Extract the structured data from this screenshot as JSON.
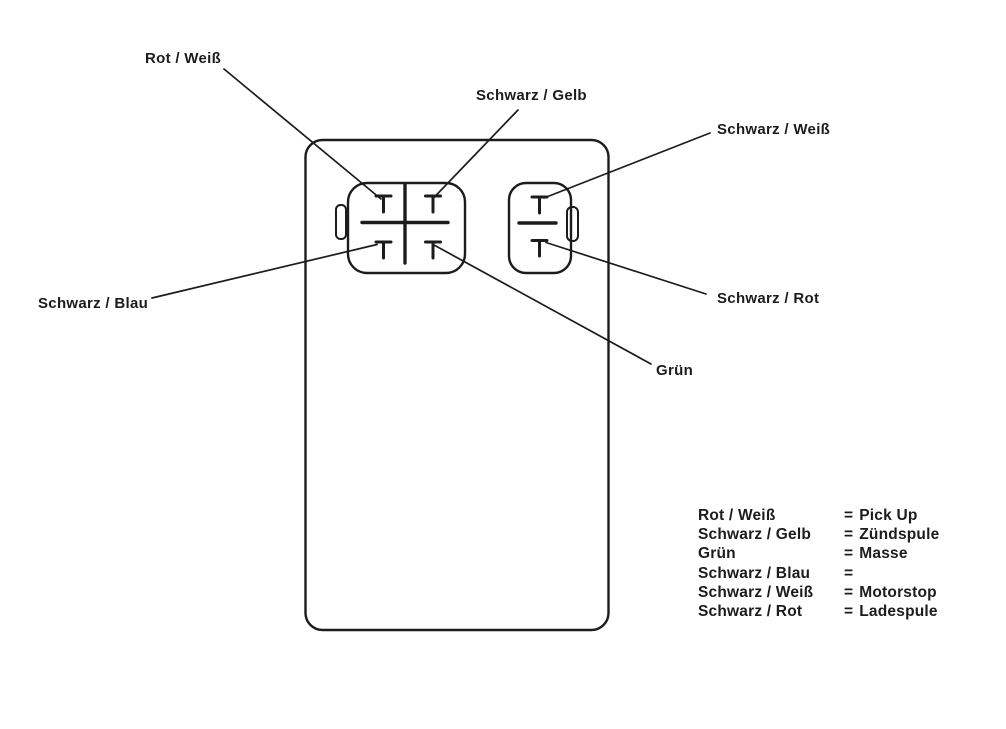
{
  "page": {
    "background_color": "#ffffff",
    "ink_color": "#1c1c1c",
    "kind": "CDI unit wiring diagram"
  },
  "labels": {
    "rot_weiss": "Rot / Weiß",
    "schwarz_gelb": "Schwarz / Gelb",
    "schwarz_weiss": "Schwarz / Weiß",
    "schwarz_rot": "Schwarz / Rot",
    "schwarz_blau": "Schwarz / Blau",
    "gruen": "Grün"
  },
  "connections": [
    {
      "wire": "Rot / Weiß",
      "pin": "4pin-top-left"
    },
    {
      "wire": "Schwarz / Gelb",
      "pin": "4pin-top-right"
    },
    {
      "wire": "Schwarz / Blau",
      "pin": "4pin-bottom-left"
    },
    {
      "wire": "Grün",
      "pin": "4pin-bottom-right"
    },
    {
      "wire": "Schwarz / Weiß",
      "pin": "2pin-top"
    },
    {
      "wire": "Schwarz / Rot",
      "pin": "2pin-bottom"
    }
  ],
  "legend": {
    "rows": [
      {
        "wire": "Rot / Weiß",
        "eq": "=",
        "function": "Pick Up"
      },
      {
        "wire": "Schwarz / Gelb",
        "eq": "=",
        "function": "Zündspule"
      },
      {
        "wire": "Grün",
        "eq": "=",
        "function": "Masse"
      },
      {
        "wire": "Schwarz / Blau",
        "eq": "=",
        "function": ""
      },
      {
        "wire": "Schwarz / Weiß",
        "eq": "=",
        "function": "Motorstop"
      },
      {
        "wire": "Schwarz / Rot",
        "eq": "=",
        "function": "Ladespule"
      }
    ]
  }
}
